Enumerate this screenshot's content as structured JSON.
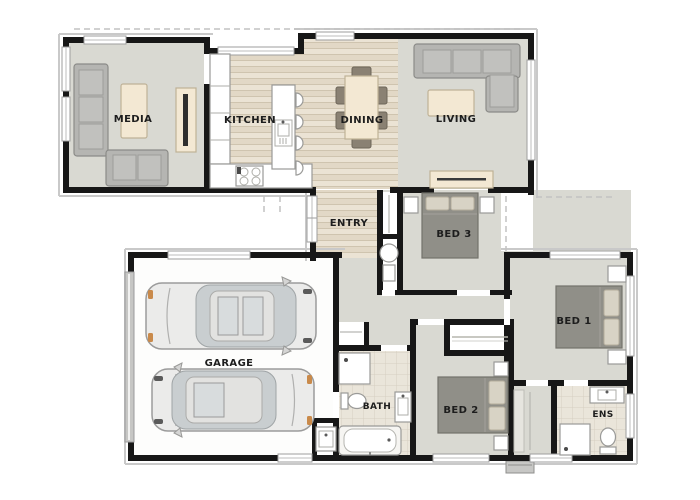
{
  "page": {
    "title": "House Floor Plan"
  },
  "rooms": {
    "media": {
      "label": "MEDIA"
    },
    "kitchen": {
      "label": "KITCHEN"
    },
    "dining": {
      "label": "DINING"
    },
    "living": {
      "label": "LIVING"
    },
    "entry": {
      "label": "ENTRY"
    },
    "bed3": {
      "label": "BED 3"
    },
    "bed1": {
      "label": "BED 1"
    },
    "bed2": {
      "label": "BED 2"
    },
    "garage": {
      "label": "GARAGE"
    },
    "bath": {
      "label": "BATH"
    },
    "ens": {
      "label": "ENS"
    }
  },
  "colors": {
    "wall": "#171717",
    "carpet": "#d9d9d2",
    "wood_light": "#ebe3d4",
    "wood_dark": "#e2d8c6",
    "tile": "#eae5da",
    "furniture_gray": "#b5b5b2",
    "bed_gray": "#908f88",
    "accent_beige": "#f3e8d3",
    "car_accent_orange": "#c98a4b",
    "window_frame": "#9e9e9e"
  }
}
